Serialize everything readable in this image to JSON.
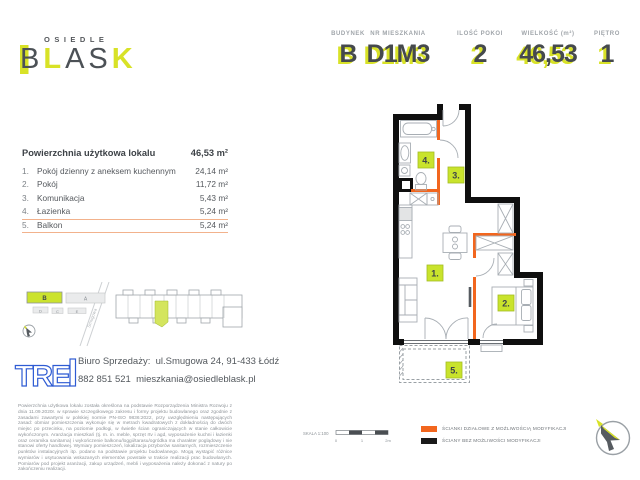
{
  "brand": {
    "estate": "OSIEDLE",
    "name_letters": [
      "B",
      "L",
      "A",
      "S",
      "K"
    ]
  },
  "header": {
    "cells": [
      {
        "label": "BUDYNEK",
        "value": "B"
      },
      {
        "label": "NR MIESZKANIA",
        "value": "D1M3"
      },
      {
        "label": "ILOŚĆ POKOI",
        "value": "2"
      },
      {
        "label": "WIELKOŚĆ (m²)",
        "value": "46,53"
      },
      {
        "label": "PIĘTRO",
        "value": "1"
      }
    ]
  },
  "area_table": {
    "title": "Powierzchnia użytkowa lokalu",
    "total": "46,53 m²",
    "rows": [
      {
        "no": "1.",
        "name": "Pokój dzienny z aneksem kuchennym",
        "area": "24,14 m²"
      },
      {
        "no": "2.",
        "name": "Pokój",
        "area": "11,72 m²"
      },
      {
        "no": "3.",
        "name": "Komunikacja",
        "area": "5,43 m²"
      },
      {
        "no": "4.",
        "name": "Łazienka",
        "area": "5,24 m²"
      },
      {
        "no": "5.",
        "name": "Balkon",
        "area": "5,24 m²"
      }
    ]
  },
  "site_map": {
    "block_b": "B",
    "block_a": "A",
    "block_d": "D",
    "block_c": "C",
    "block_e": "E",
    "road": "Smugowa"
  },
  "floor_plan": {
    "labels": {
      "r1": "1.",
      "r2": "2.",
      "r3": "3.",
      "r4": "4.",
      "r5": "5."
    }
  },
  "scale_bar": {
    "label": "SKALA 1:100",
    "tick0": "0",
    "tick1": "1",
    "tick2": "2m"
  },
  "legend": {
    "modifiable": "ŚCIANKI DZIAŁOWE Z MOŻLIWOŚCIĄ MODYFIKACJI",
    "fixed": "ŚCIANY BEZ MOŻLIWOŚCI MODYFIKACJI"
  },
  "contact": {
    "logo": "TRE",
    "line1": "Biuro Sprzedaży:  ul.Smugowa 24, 91-433 Łódź",
    "line2": "882 851 521  mieszkania@osiedleblask.pl"
  },
  "disclaimer": "Powierzchnia użytkowa lokalu została określona na podstawie Rozporządzenia Ministra Rozwoju z dnia 11.09.2020r. w sprawie szczegółowego zakresu i formy projektu budowlanego oraz zgodnie z zasadami zawartymi w polskiej normie PN-ISO 9836:2022, przy uwzględnieniu następujących zasad: obmiar pomieszczenia wykonuje się w metrach kwadratowych z dokładnością do dwóch miejsc po przecinku, na poziomie podłogi, w świetle ścian ograniczających w stanie całkowicie wykończonym. Aranżacja mieszkań (tj. m. in. meble, sprzęt rtv i agd, wyposażenie kuchni i łazienki oraz ceramika sanitarna) i wykończenie balkonu/loggii/tarasu/ogródka ma charakter poglądowy i nie stanowi oferty handlowej. Wymiary pomieszczeń, lokalizacja przyborów sanitarnych, rozmieszczenie punktów instalacyjnych itp. podano na podstawie projektu budowlanego. Mogą wystąpić różnice wymiarów i usytuowania wskazanych elementów powstałe w trakcie realizacji prac budowlanych. Pomiarów pod projekt aranżacji, zakup urządzeń, mebli i wyposażenia należy dokonać z natury po zakończeniu realizacji.",
  "colors": {
    "accent_yellow": "#d8e227",
    "room_badge": "#c9e32c",
    "wall_orange": "#f2661e",
    "wall_black": "#0f0f0f",
    "tre_blue": "#2e5bd3",
    "underline_orange": "#f2b28c"
  }
}
